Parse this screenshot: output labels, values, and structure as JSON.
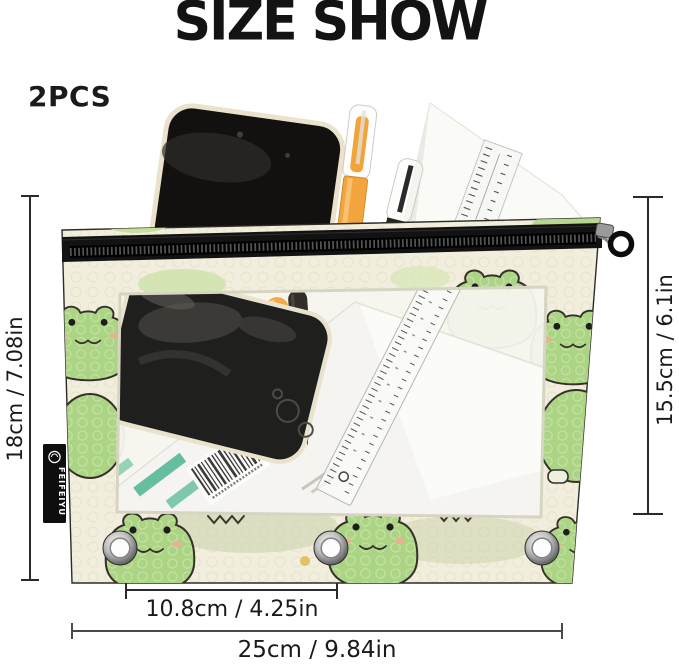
{
  "title": "SIZE SHOW",
  "quantity": "2PCS",
  "brand_tag": "FEIFEIYU",
  "measurements": {
    "pouch_height": "18cm / 7.08in",
    "window_height": "15.5cm / 6.1in",
    "grommet_spacing": "10.8cm / 4.25in",
    "pouch_width": "25cm / 9.84in"
  },
  "scene": {
    "product": "zipper binder pencil pouch with cartoon frog pattern and clear window",
    "items_shown": [
      "black smartphone",
      "orange gel pen",
      "black pen",
      "transparent ruler",
      "white paper sheet"
    ],
    "grommet_count": "3"
  },
  "colors": {
    "page_bg": "#ffffff",
    "text": "#1a1a1a",
    "fabric_cream": "#f1eedd",
    "frog_green": "#abd485",
    "lily_pad_green": "#cfe3ab",
    "zipper_black": "#121212",
    "pen_orange": "#f2a53c",
    "stripe_teal": "#49b48e"
  }
}
